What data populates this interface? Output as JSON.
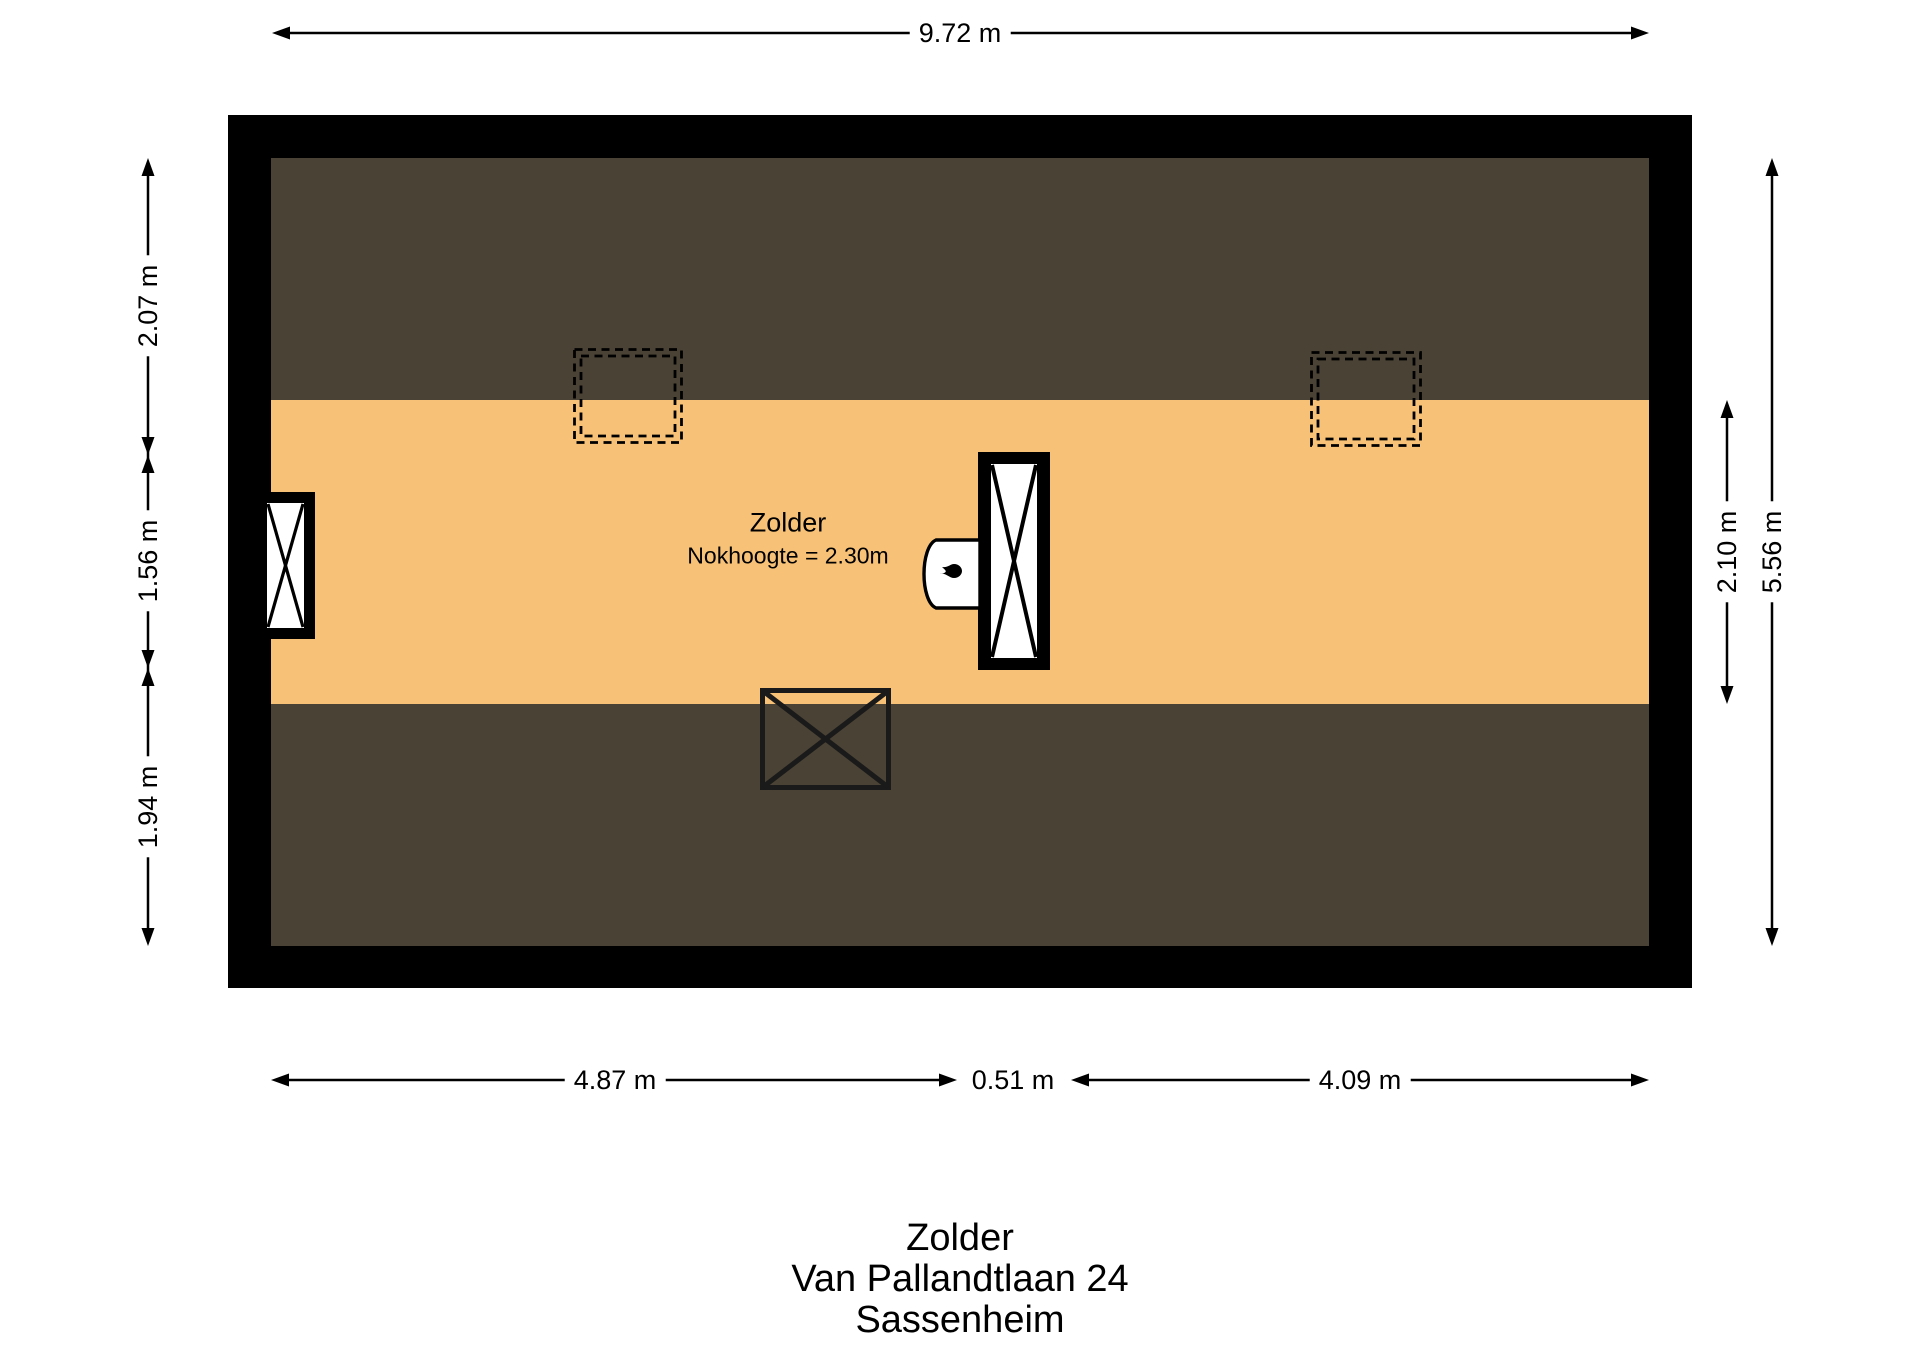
{
  "colors": {
    "wall": "#000000",
    "roof_slope": "#4a4234",
    "floor": "#f7c277"
  },
  "floor_plan": {
    "room_label": "Zolder",
    "ridge_height_label": "Nokhoogte = 2.30m",
    "features": {
      "skylights": 2,
      "window": "left-wall-window",
      "chimney": "center-duct-with-cross",
      "boiler_icon": "flame-icon",
      "stair_opening": "crossed-rectangle"
    }
  },
  "dimensions": {
    "top_width": "9.72 m",
    "left_top": "2.07 m",
    "left_middle": "1.56 m",
    "left_bottom": "1.94 m",
    "right_inner": "2.10 m",
    "right_outer": "5.56 m",
    "bottom_left": "4.87 m",
    "bottom_middle": "0.51 m",
    "bottom_right": "4.09 m"
  },
  "footer": {
    "room": "Zolder",
    "address": "Van Pallandtlaan 24",
    "city": "Sassenheim"
  }
}
